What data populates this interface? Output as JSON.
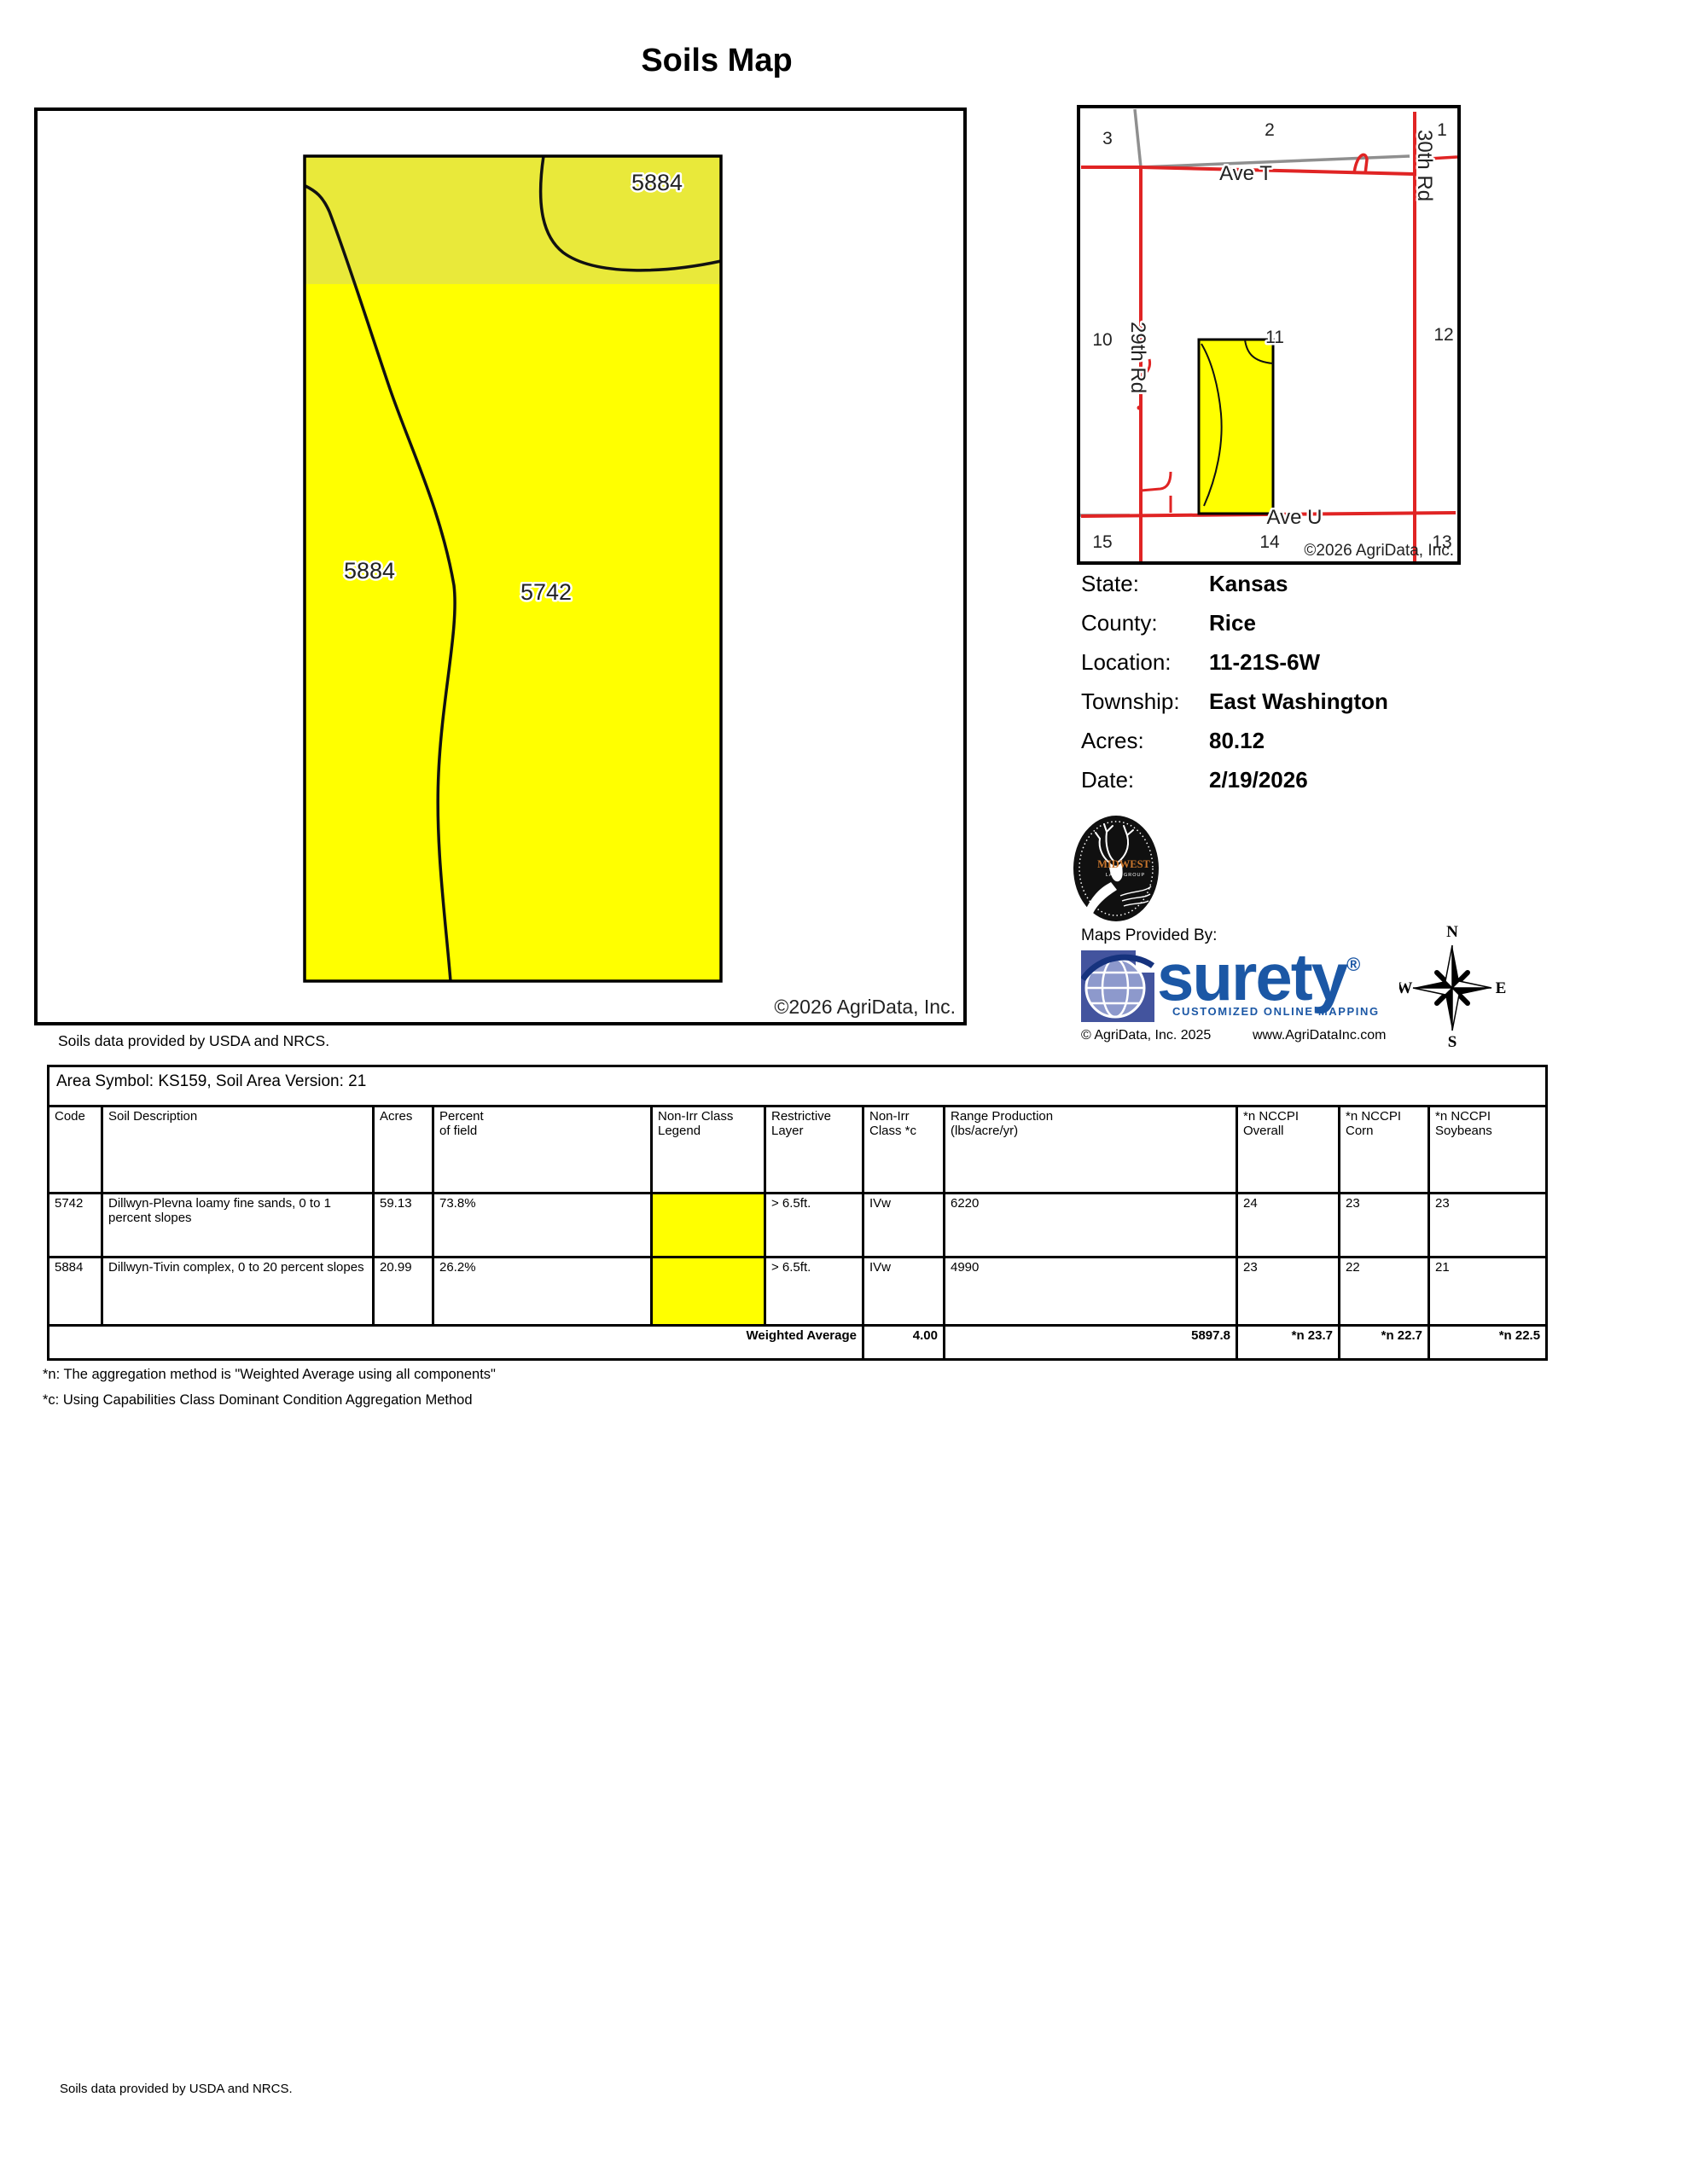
{
  "title": "Soils Map",
  "map": {
    "label_top_right": "5884",
    "label_left": "5884",
    "label_center": "5742",
    "copyright": "©2026 AgriData, Inc."
  },
  "locator": {
    "sections": [
      "3",
      "2",
      "1",
      "10",
      "11",
      "12",
      "15",
      "14",
      "13"
    ],
    "roads": {
      "ave_t": "Ave T",
      "ave_u": "Ave U",
      "rd29": "29th Rd",
      "rd30": "30th Rd"
    },
    "copyright": "©2026 AgriData, Inc."
  },
  "info": {
    "rows": [
      {
        "label": "State:",
        "value": "Kansas"
      },
      {
        "label": "County:",
        "value": "Rice"
      },
      {
        "label": "Location:",
        "value": "11-21S-6W"
      },
      {
        "label": "Township:",
        "value": "East Washington"
      },
      {
        "label": "Acres:",
        "value": "80.12"
      },
      {
        "label": "Date:",
        "value": "2/19/2026"
      }
    ]
  },
  "branding": {
    "midwest_name": "MIDWEST",
    "midwest_sub": "LAND GROUP",
    "maps_provided_by": "Maps Provided By:",
    "surety": "surety",
    "surety_reg": "®",
    "surety_tagline": "CUSTOMIZED ONLINE MAPPING",
    "agridata_copyright": "© AgriData, Inc. 2025",
    "website": "www.AgriDataInc.com"
  },
  "compass": {
    "n": "N",
    "e": "E",
    "s": "S",
    "w": "W"
  },
  "usda_note": "Soils data provided by USDA and NRCS.",
  "usda_note_bottom": "Soils data provided by USDA and NRCS.",
  "table": {
    "area_symbol": "Area Symbol: KS159, Soil Area Version: 21",
    "headers": {
      "code": "Code",
      "description": "Soil Description",
      "acres": "Acres",
      "percent": "Percent\nof field",
      "legend": "Non-Irr Class\nLegend",
      "restrictive": "Restrictive\nLayer",
      "nonirr_class": "Non-Irr\nClass *c",
      "production": "Range Production\n(lbs/acre/yr)",
      "nccpi_overall": "*n NCCPI\nOverall",
      "nccpi_corn": "*n NCCPI\nCorn",
      "nccpi_soybeans": "*n NCCPI\nSoybeans"
    },
    "rows": [
      {
        "code": "5742",
        "description": "Dillwyn-Plevna loamy fine sands, 0 to 1 percent slopes",
        "acres": "59.13",
        "percent": "73.8%",
        "restrictive": "> 6.5ft.",
        "nonirr_class": "IVw",
        "production": "6220",
        "nccpi_overall": "24",
        "nccpi_corn": "23",
        "nccpi_soybeans": "23"
      },
      {
        "code": "5884",
        "description": "Dillwyn-Tivin complex, 0 to 20 percent slopes",
        "acres": "20.99",
        "percent": "26.2%",
        "restrictive": "> 6.5ft.",
        "nonirr_class": "IVw",
        "production": "4990",
        "nccpi_overall": "23",
        "nccpi_corn": "22",
        "nccpi_soybeans": "21"
      }
    ],
    "weighted": {
      "label": "Weighted Average",
      "nonirr_class": "4.00",
      "production": "5897.8",
      "nccpi_overall": "*n 23.7",
      "nccpi_corn": "*n 22.7",
      "nccpi_soybeans": "*n 22.5"
    }
  },
  "footnotes": [
    "*n: The aggregation method is \"Weighted Average using all components\"",
    "*c: Using Capabilities Class Dominant Condition Aggregation Method"
  ],
  "colors": {
    "field_yellow": "#ffff00",
    "field_band": "#e9e93a",
    "road_red": "#e02424",
    "road_gray": "#8f8f8f",
    "surety_blue": "#1b57a5",
    "midwest_orange": "#c9762d"
  }
}
